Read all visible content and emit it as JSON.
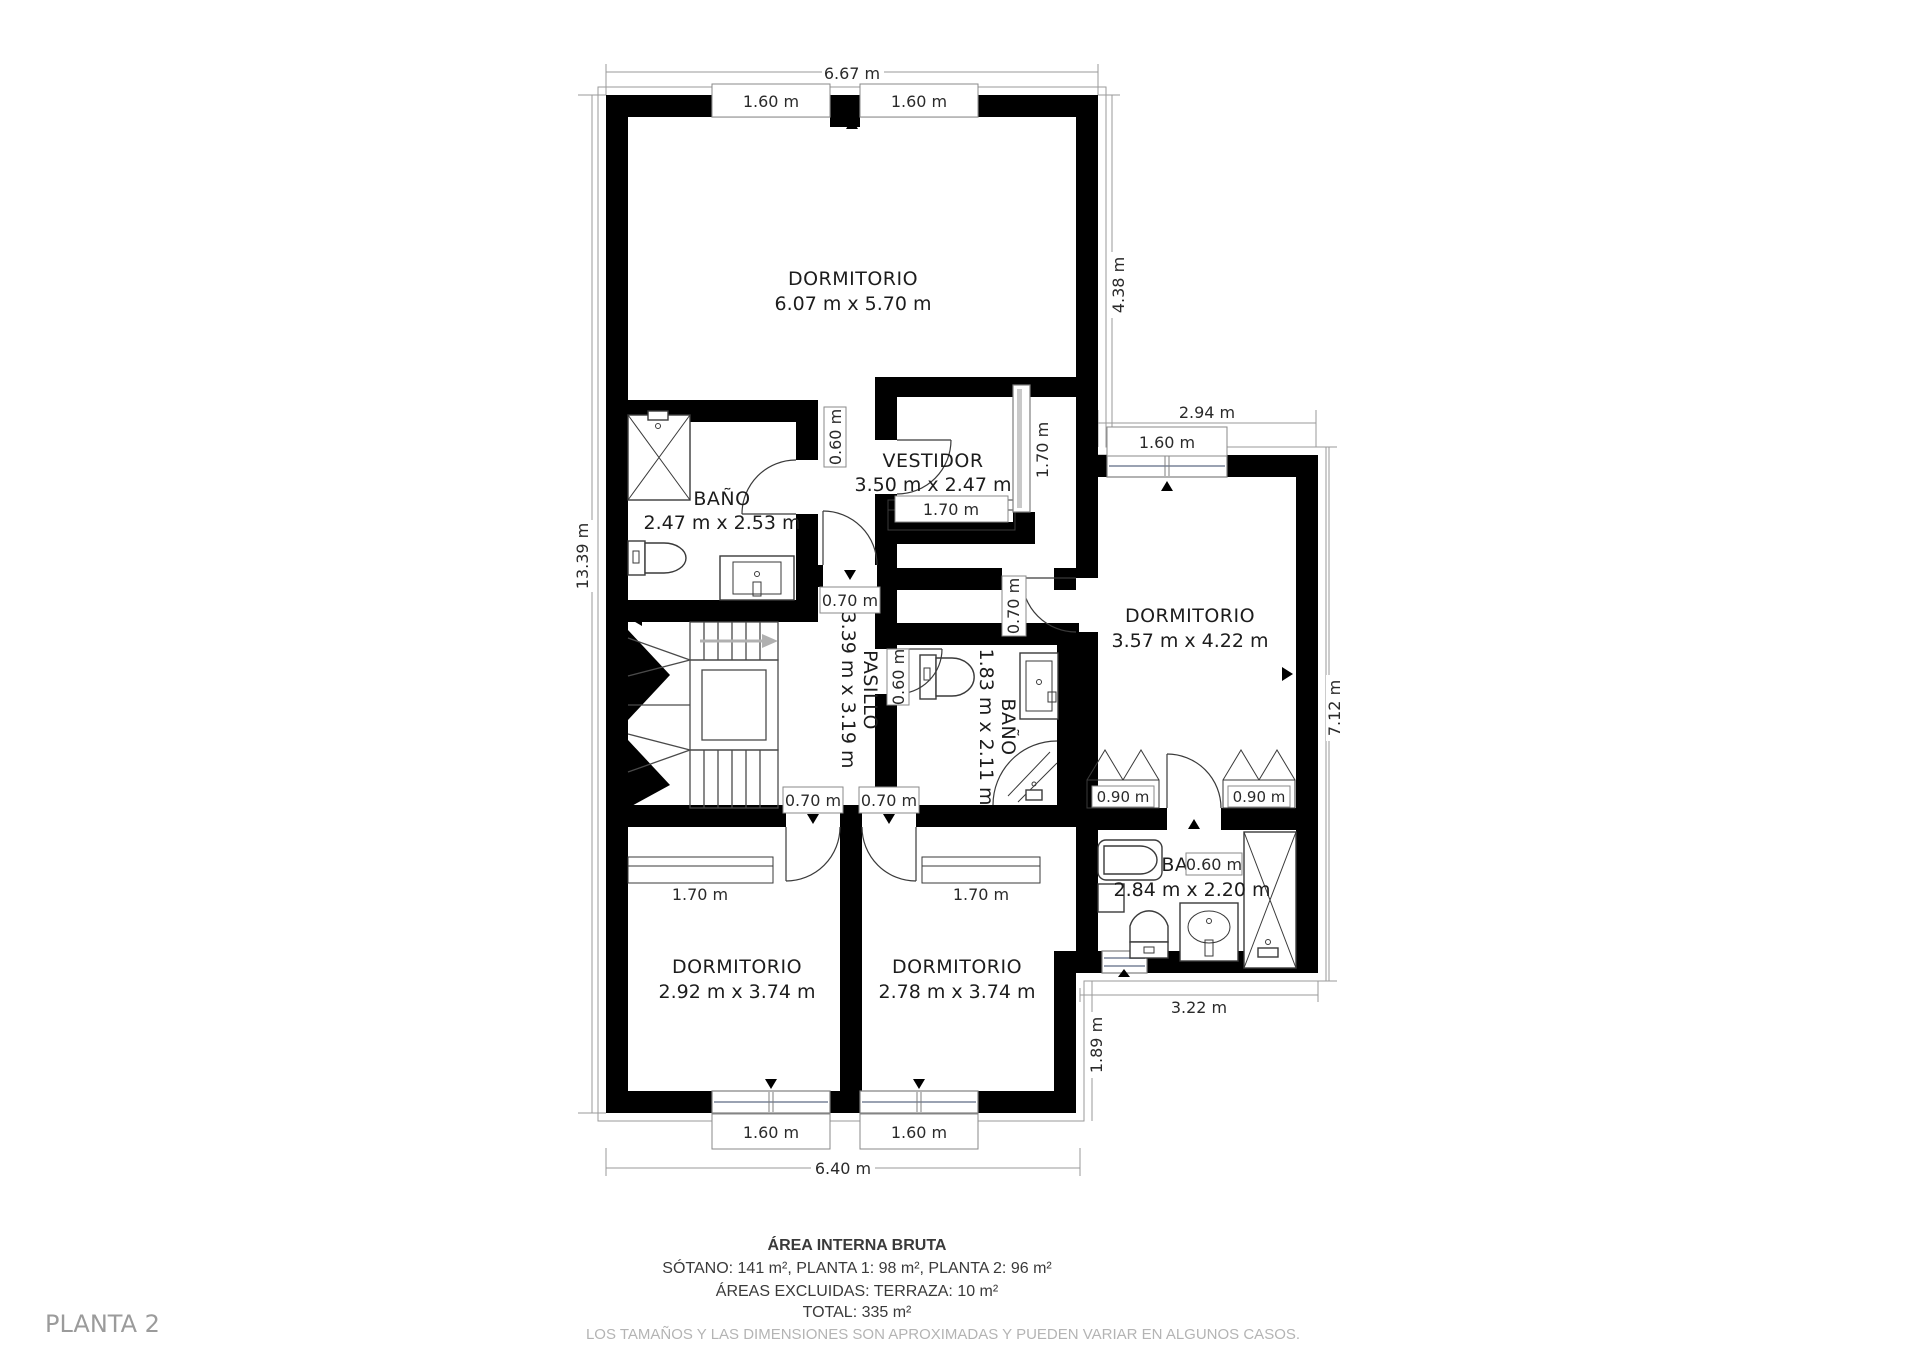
{
  "plan_label": "PLANTA 2",
  "rooms": {
    "dorm_top": {
      "name": "DORMITORIO",
      "dims": "6.07 m x 5.70 m"
    },
    "bano1": {
      "name": "BAÑO",
      "dims": "2.47 m x 2.53 m"
    },
    "vestidor": {
      "name": "VESTIDOR",
      "dims": "3.50 m x 2.47 m"
    },
    "dorm_right": {
      "name": "DORMITORIO",
      "dims": "3.57 m x 4.22 m"
    },
    "pasillo": {
      "name": "PASILLO",
      "dims": "3.39 m x 3.19 m"
    },
    "bano2": {
      "name": "BAÑO",
      "dims": "1.83 m x 2.11 m"
    },
    "bano3": {
      "name": "BAÑO",
      "dims": "2.84 m x 2.20 m"
    },
    "dorm_bl": {
      "name": "DORMITORIO",
      "dims": "2.92 m x 3.74 m"
    },
    "dorm_br": {
      "name": "DORMITORIO",
      "dims": "2.78 m x 3.74 m"
    }
  },
  "dimensions": {
    "top_width": "6.67 m",
    "left_height": "13.39 m",
    "right_upper": "4.38 m",
    "wing_width": "2.94 m",
    "wing_height": "7.12 m",
    "wing_bottom": "3.22 m",
    "right_lower": "1.89 m",
    "bottom_width": "6.40 m",
    "win_top_left": "1.60 m",
    "win_top_right": "1.60 m",
    "win_wing": "1.60 m",
    "win_bottom_left": "1.60 m",
    "win_bottom_right": "1.60 m"
  },
  "openings": {
    "bano1_door": "0.60 m",
    "corridor_door": "0.70 m",
    "vestidor_wardrobe": "1.70 m",
    "vestidor_slider": "1.70 m",
    "wing_door": "0.70 m",
    "bano2_door": "0.60 m",
    "door_bl": "0.70 m",
    "door_br": "0.70 m",
    "closet_bl": "1.70 m",
    "closet_br": "1.70 m",
    "closet_wing_left": "0.90 m",
    "closet_wing_right": "0.90 m",
    "bano3_shower": "0.60 m"
  },
  "footer": {
    "title": "ÁREA INTERNA BRUTA",
    "areas": "SÓTANO: 141 m², PLANTA 1: 98 m², PLANTA 2: 96 m²",
    "excluded": "ÁREAS EXCLUIDAS: TERRAZA: 10 m²",
    "total": "TOTAL: 335 m²",
    "note": "LOS TAMAÑOS Y LAS DIMENSIONES SON APROXIMADAS Y PUEDEN VARIAR EN ALGUNOS CASOS."
  }
}
